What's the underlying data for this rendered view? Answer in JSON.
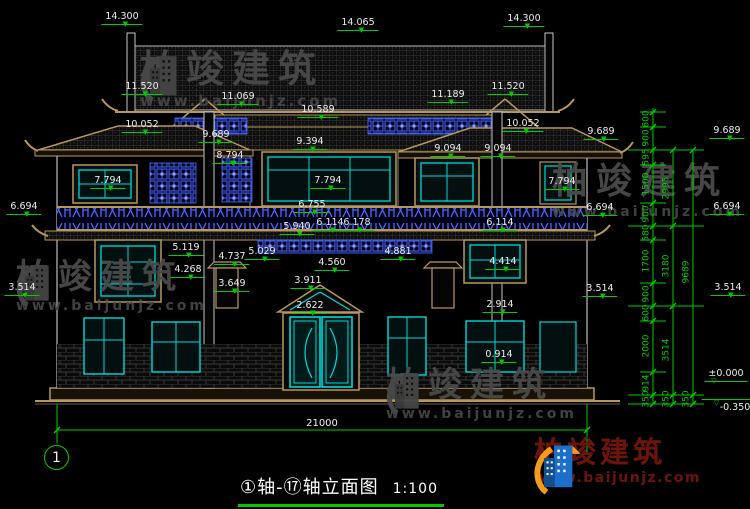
{
  "drawing": {
    "title": "①轴-⑰轴立面图",
    "scale": "1:100",
    "axis_bubble": "1",
    "overall_width_dim": "21000"
  },
  "brand": {
    "name": "柏竣建筑",
    "site": "www.baijunjz.com"
  },
  "watermark": {
    "name": "柏竣建筑",
    "site": "www.baijunjz.com"
  },
  "elevation_labels": [
    {
      "v": "14.300",
      "x": 122,
      "y": 12
    },
    {
      "v": "14.065",
      "x": 358,
      "y": 18
    },
    {
      "v": "14.300",
      "x": 524,
      "y": 14
    },
    {
      "v": "11.520",
      "x": 142,
      "y": 82
    },
    {
      "v": "11.069",
      "x": 238,
      "y": 92
    },
    {
      "v": "10.589",
      "x": 318,
      "y": 105
    },
    {
      "v": "11.189",
      "x": 448,
      "y": 90
    },
    {
      "v": "11.520",
      "x": 508,
      "y": 82
    },
    {
      "v": "10.052",
      "x": 142,
      "y": 120
    },
    {
      "v": "9.689",
      "x": 216,
      "y": 130
    },
    {
      "v": "9.394",
      "x": 310,
      "y": 137
    },
    {
      "v": "8.794",
      "x": 230,
      "y": 151
    },
    {
      "v": "9.094",
      "x": 448,
      "y": 144
    },
    {
      "v": "9.094",
      "x": 498,
      "y": 144
    },
    {
      "v": "10.052",
      "x": 523,
      "y": 119
    },
    {
      "v": "9.689",
      "x": 601,
      "y": 127
    },
    {
      "v": "9.689",
      "x": 727,
      "y": 126
    },
    {
      "v": "7.794",
      "x": 108,
      "y": 176
    },
    {
      "v": "7.794",
      "x": 328,
      "y": 176
    },
    {
      "v": "7.794",
      "x": 562,
      "y": 177
    },
    {
      "v": "6.694",
      "x": 24,
      "y": 202
    },
    {
      "v": "6.755",
      "x": 312,
      "y": 200
    },
    {
      "v": "5.940",
      "x": 297,
      "y": 222
    },
    {
      "v": "6.114",
      "x": 330,
      "y": 218
    },
    {
      "v": "6.178",
      "x": 357,
      "y": 218
    },
    {
      "v": "6.694",
      "x": 600,
      "y": 203
    },
    {
      "v": "6.694",
      "x": 727,
      "y": 202
    },
    {
      "v": "6.114",
      "x": 500,
      "y": 218
    },
    {
      "v": "5.119",
      "x": 186,
      "y": 243
    },
    {
      "v": "5.029",
      "x": 262,
      "y": 247
    },
    {
      "v": "4.737",
      "x": 232,
      "y": 252
    },
    {
      "v": "4.268",
      "x": 188,
      "y": 265
    },
    {
      "v": "3.649",
      "x": 232,
      "y": 279
    },
    {
      "v": "4.560",
      "x": 332,
      "y": 258
    },
    {
      "v": "4.881",
      "x": 398,
      "y": 247
    },
    {
      "v": "4.414",
      "x": 503,
      "y": 257
    },
    {
      "v": "3.911",
      "x": 308,
      "y": 276
    },
    {
      "v": "3.514",
      "x": 22,
      "y": 283
    },
    {
      "v": "3.514",
      "x": 600,
      "y": 284
    },
    {
      "v": "3.514",
      "x": 728,
      "y": 283
    },
    {
      "v": "2.914",
      "x": 500,
      "y": 300
    },
    {
      "v": "2.622",
      "x": 310,
      "y": 301
    },
    {
      "v": "0.914",
      "x": 499,
      "y": 350
    },
    {
      "v": "±0.000",
      "x": 726,
      "y": 369,
      "cls": "open"
    },
    {
      "v": "-0.350",
      "x": 728,
      "y": 399,
      "cls": "below"
    }
  ],
  "dim_chains": [
    {
      "x": 647,
      "segments": [
        {
          "v": "600",
          "y": 119
        },
        {
          "v": "900",
          "y": 138
        },
        {
          "v": "595",
          "y": 157
        },
        {
          "v": "1500",
          "y": 184
        },
        {
          "v": "900",
          "y": 214
        },
        {
          "v": "580",
          "y": 233
        },
        {
          "v": "1700",
          "y": 261
        },
        {
          "v": "900",
          "y": 294
        },
        {
          "v": "600",
          "y": 313
        },
        {
          "v": "2000",
          "y": 346
        },
        {
          "v": "914",
          "y": 383
        },
        {
          "v": "350",
          "y": 399
        }
      ]
    },
    {
      "x": 667,
      "segments": [
        {
          "v": "2995",
          "y": 188
        },
        {
          "v": "3180",
          "y": 266
        },
        {
          "v": "3514",
          "y": 350
        },
        {
          "v": "350",
          "y": 399
        }
      ]
    },
    {
      "x": 687,
      "segments": [
        {
          "v": "9689",
          "y": 272
        },
        {
          "v": "350",
          "y": 399
        }
      ]
    }
  ],
  "watermark_instances": [
    {
      "x": 140,
      "y": 50,
      "fs": 38,
      "logo": true
    },
    {
      "x": 16,
      "y": 260,
      "fs": 34,
      "logo": true
    },
    {
      "x": 552,
      "y": 164,
      "fs": 36,
      "logo": false
    },
    {
      "x": 386,
      "y": 368,
      "fs": 34,
      "logo": true
    }
  ]
}
